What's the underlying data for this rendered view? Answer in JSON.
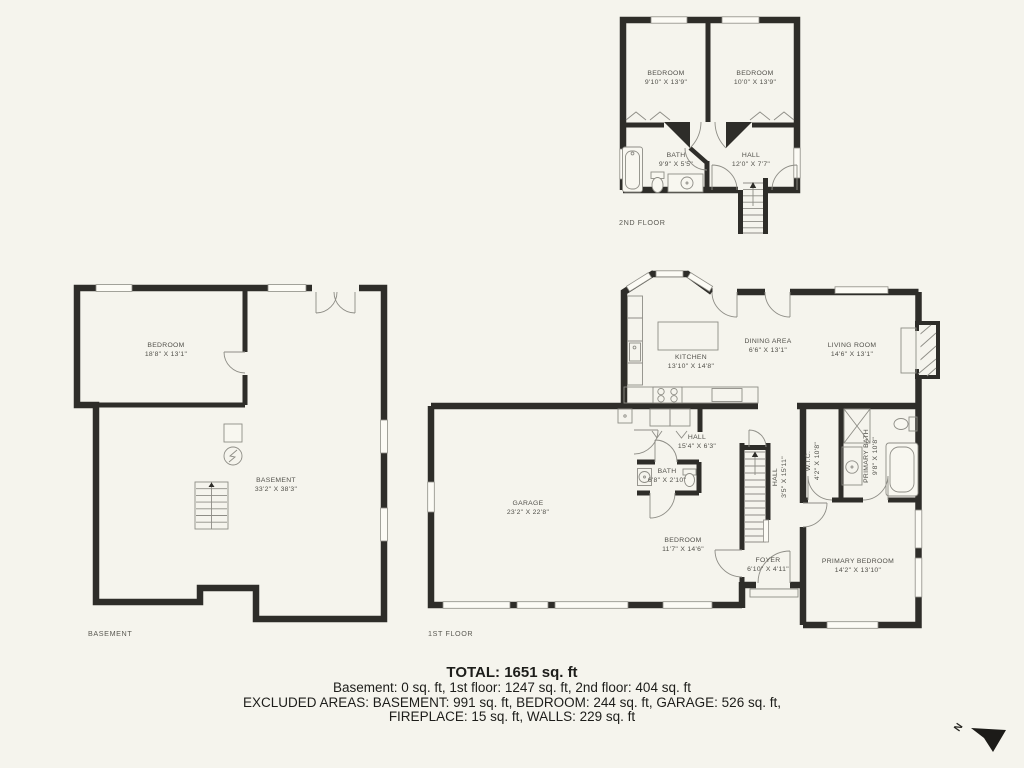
{
  "colors": {
    "background": "#f5f4ed",
    "wall": "#2e2d29",
    "thin_line": "#8e8d86",
    "room_label": "#51504a",
    "summary_text": "#1d1d1a"
  },
  "floors": {
    "second": {
      "label": "2ND FLOOR",
      "rooms": {
        "bedroom_left": {
          "name": "BEDROOM",
          "dims": "9'10\" X 13'9\""
        },
        "bedroom_right": {
          "name": "BEDROOM",
          "dims": "10'0\" X 13'9\""
        },
        "bath": {
          "name": "BATH",
          "dims": "9'9\" X 5'5\""
        },
        "hall": {
          "name": "HALL",
          "dims": "12'0\" X 7'7\""
        }
      }
    },
    "basement": {
      "label": "BASEMENT",
      "rooms": {
        "bedroom": {
          "name": "BEDROOM",
          "dims": "18'8\" X 13'1\""
        },
        "basement": {
          "name": "BASEMENT",
          "dims": "33'2\" X 38'3\""
        }
      }
    },
    "first": {
      "label": "1ST FLOOR",
      "rooms": {
        "kitchen": {
          "name": "KITCHEN",
          "dims": "13'10\" X 14'8\""
        },
        "dining": {
          "name": "DINING AREA",
          "dims": "6'6\" X 13'1\""
        },
        "living": {
          "name": "LIVING ROOM",
          "dims": "14'6\" X 13'1\""
        },
        "garage": {
          "name": "GARAGE",
          "dims": "23'2\" X 22'8\""
        },
        "hall_upper": {
          "name": "HALL",
          "dims": "15'4\" X 6'3\""
        },
        "bath": {
          "name": "BATH",
          "dims": "6'8\" X 2'10\""
        },
        "hall_vertical": {
          "name": "HALL",
          "dims": "3'5\" X 15'11\""
        },
        "wic": {
          "name": "W.I.C.",
          "dims": "4'2\" X 10'8\""
        },
        "primary_bath": {
          "name": "PRIMARY BATH",
          "dims": "9'8\" X 10'8\""
        },
        "bedroom": {
          "name": "BEDROOM",
          "dims": "11'7\" X 14'6\""
        },
        "foyer": {
          "name": "FOYER",
          "dims": "6'10\" X 4'11\""
        },
        "primary_bedroom": {
          "name": "PRIMARY BEDROOM",
          "dims": "14'2\" X 13'10\""
        }
      }
    }
  },
  "summary": {
    "total": "TOTAL: 1651 sq. ft",
    "by_floor": "Basement: 0 sq. ft, 1st floor: 1247 sq. ft, 2nd floor: 404 sq. ft",
    "excluded_1": "EXCLUDED AREAS: BASEMENT: 991 sq. ft, BEDROOM: 244 sq. ft, GARAGE: 526 sq. ft,",
    "excluded_2": "FIREPLACE: 15 sq. ft, WALLS: 229 sq. ft"
  },
  "compass": {
    "label": "N"
  }
}
